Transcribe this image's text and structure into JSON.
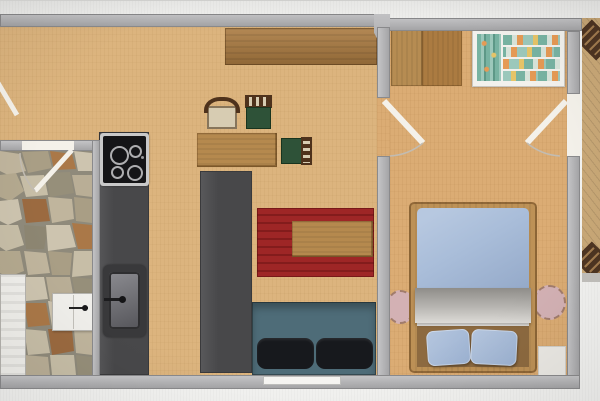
{
  "scene": {
    "type": "floor-plan",
    "description": "Top-down apartment floor plan (photo of a screen), no visible text",
    "rooms": [
      {
        "name": "living-kitchen",
        "floor": "light-wood"
      },
      {
        "name": "bathroom",
        "floor": "natural-stone"
      },
      {
        "name": "bedroom",
        "floor": "light-wood"
      },
      {
        "name": "balcony-deck",
        "floor": "wood-planks"
      }
    ],
    "furniture": [
      {
        "name": "sideboard",
        "room": "living-kitchen"
      },
      {
        "name": "dining-table",
        "room": "living-kitchen"
      },
      {
        "name": "upholstered-chair",
        "room": "living-kitchen"
      },
      {
        "name": "green-chair-top",
        "room": "living-kitchen"
      },
      {
        "name": "green-chair-side",
        "room": "living-kitchen"
      },
      {
        "name": "cooktop",
        "room": "living-kitchen"
      },
      {
        "name": "kitchen-counter",
        "room": "living-kitchen"
      },
      {
        "name": "kitchen-sink",
        "room": "living-kitchen"
      },
      {
        "name": "island-counter",
        "room": "living-kitchen"
      },
      {
        "name": "area-rug",
        "room": "living-kitchen"
      },
      {
        "name": "coffee-table",
        "room": "living-kitchen"
      },
      {
        "name": "sofa",
        "room": "living-kitchen"
      },
      {
        "name": "radiator",
        "room": "bathroom"
      },
      {
        "name": "wall-cabinet",
        "room": "bathroom"
      },
      {
        "name": "wardrobe-left",
        "room": "bedroom"
      },
      {
        "name": "wardrobe-right",
        "room": "bedroom"
      },
      {
        "name": "open-closet-with-clothes",
        "room": "bedroom"
      },
      {
        "name": "double-bed",
        "room": "bedroom"
      },
      {
        "name": "round-nightstand-left",
        "room": "bedroom"
      },
      {
        "name": "round-nightstand-right",
        "room": "bedroom"
      },
      {
        "name": "floor-mat",
        "room": "bedroom"
      },
      {
        "name": "stairs-upper",
        "room": "balcony-deck"
      },
      {
        "name": "stairs-lower",
        "room": "balcony-deck"
      }
    ],
    "openings": {
      "doors": [
        "entry-door-left",
        "bathroom-door",
        "bedroom-door-left",
        "bedroom-door-right"
      ],
      "windows": [
        "living-room-bottom-window"
      ]
    }
  },
  "colors": {
    "background": "#f3f3f1",
    "wall": "#a2a2a4",
    "wall_light": "#c7c7c9",
    "wall_dark": "#8a8a8c",
    "floor_wood": "#dcb47e",
    "floor_bedroom": "#dbac74",
    "wood_dark": "#ab7b41",
    "wood_mid": "#b5894e",
    "counter": "#48484a",
    "appliance_frame": "#c9c9c9",
    "appliance_black": "#151517",
    "sink_outer": "#39393b",
    "rug": "#9e2626",
    "rug_stripe": "#831c1c",
    "sofa": "#4e6c78",
    "cushion": "#17191d",
    "bed_frame": "#bd9156",
    "duvet": "#a9bdd9",
    "blanket": "#b8b6b2",
    "pillow": "#9cb2d2",
    "sheet": "#e9e7e3",
    "bed_head": "#8d6a40",
    "nightstand": "#d3b1b4",
    "green_seat": "#2e5238",
    "chair_wood": "#4e321c",
    "chair_beige": "#d7ccb2",
    "closet_frame": "#f2f1ed",
    "closet_teal": "#78b3a2",
    "closet_teal2": "#9cc8bb",
    "closet_orange": "#e59a55",
    "closet_yellow": "#e6c468",
    "closet_sand": "#d8e4da",
    "deck": "#c9a877",
    "stair": "#4e3522",
    "stair_rung": "#a07a4e",
    "white_item": "#f0efeb",
    "door_leaf": "#f4f1ea",
    "swing_arc": "#c2bcb2",
    "mat": "#ebe9e4",
    "window": "#f6f5f2",
    "stone_grout": "#8f8a7b"
  }
}
